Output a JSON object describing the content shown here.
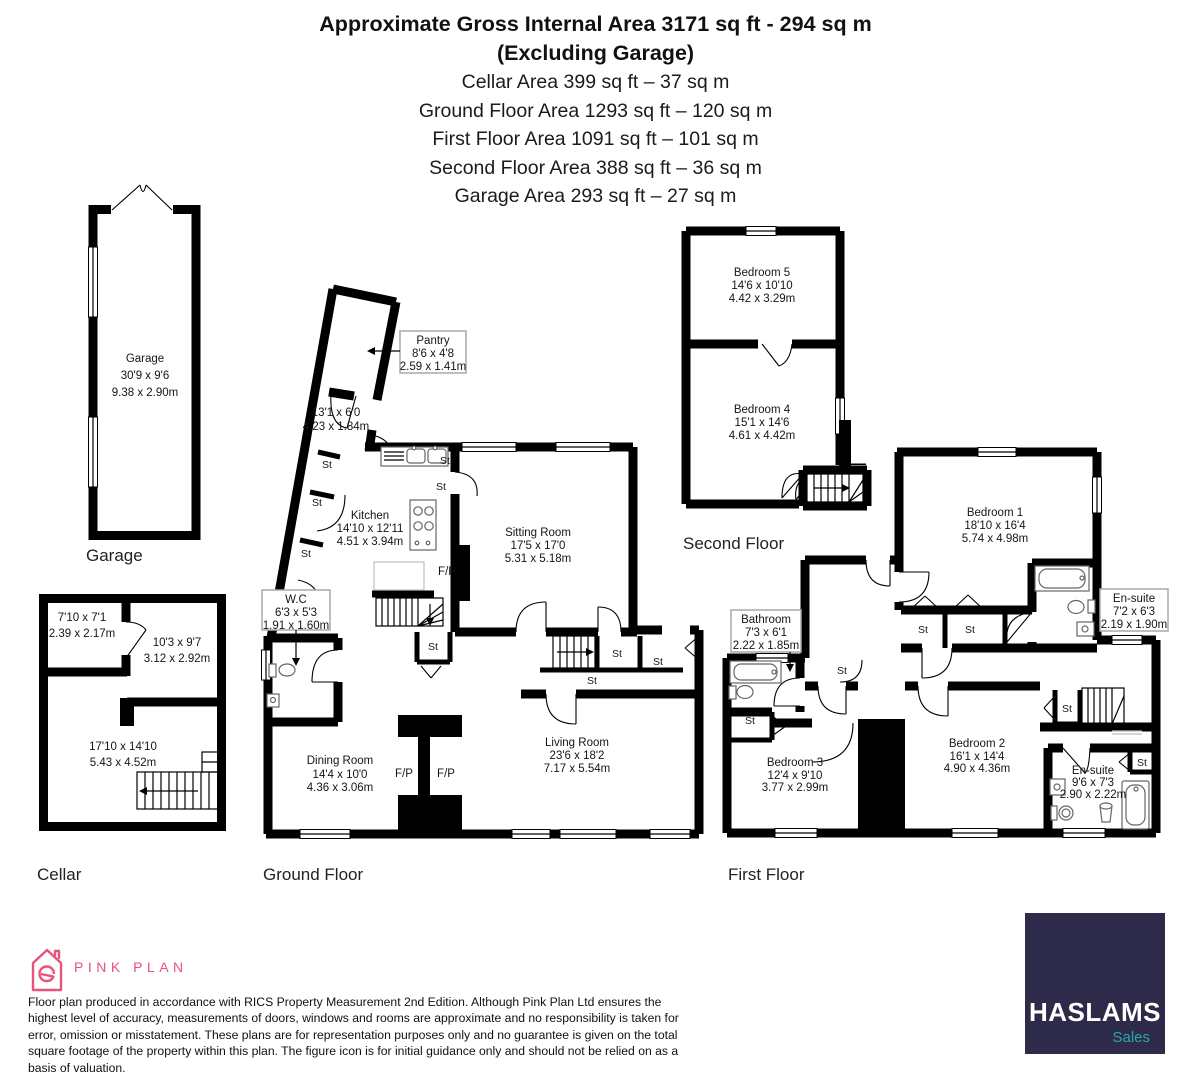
{
  "header": {
    "title1": "Approximate Gross Internal Area 3171 sq ft - 294 sq m",
    "title2": "(Excluding Garage)",
    "areas": [
      "Cellar Area 399 sq ft – 37 sq m",
      "Ground Floor Area 1293 sq ft – 120 sq m",
      "First Floor Area 1091 sq ft – 101 sq m",
      "Second Floor Area 388 sq ft – 36 sq m",
      "Garage Area 293 sq ft – 27 sq m"
    ]
  },
  "floors": {
    "garage": {
      "label": "Garage",
      "room": {
        "name": "Garage",
        "imperial": "30'9 x 9'6",
        "metric": "9.38 x 2.90m"
      }
    },
    "cellar": {
      "label": "Cellar",
      "rooms": {
        "r1": {
          "imperial": "7'10 x 7'1",
          "metric": "2.39 x 2.17m"
        },
        "r2": {
          "imperial": "10'3 x 9'7",
          "metric": "3.12 x 2.92m"
        },
        "r3": {
          "imperial": "17'10 x 14'10",
          "metric": "5.43 x 4.52m"
        }
      }
    },
    "ground": {
      "label": "Ground Floor",
      "rooms": {
        "pantry": {
          "name": "Pantry",
          "imperial": "8'6 x 4'8",
          "metric": "2.59 x 1.41m"
        },
        "corridor": {
          "imperial": "13'1 x 6'0",
          "metric": "4.23 x 1.84m"
        },
        "kitchen": {
          "name": "Kitchen",
          "imperial": "14'10 x 12'11",
          "metric": "4.51 x 3.94m"
        },
        "sitting": {
          "name": "Sitting Room",
          "imperial": "17'5 x 17'0",
          "metric": "5.31 x 5.18m"
        },
        "wc": {
          "name": "W.C",
          "imperial": "6'3 x 5'3",
          "metric": "1.91 x 1.60m"
        },
        "dining": {
          "name": "Dining Room",
          "imperial": "14'4 x 10'0",
          "metric": "4.36 x 3.06m"
        },
        "living": {
          "name": "Living Room",
          "imperial": "23'6 x 18'2",
          "metric": "7.17 x 5.54m"
        }
      }
    },
    "first": {
      "label": "First Floor",
      "rooms": {
        "bedroom1": {
          "name": "Bedroom 1",
          "imperial": "18'10 x 16'4",
          "metric": "5.74 x 4.98m"
        },
        "bedroom2": {
          "name": "Bedroom 2",
          "imperial": "16'1 x 14'4",
          "metric": "4.90 x 4.36m"
        },
        "bedroom3": {
          "name": "Bedroom 3",
          "imperial": "12'4 x 9'10",
          "metric": "3.77 x 2.99m"
        },
        "bathroom": {
          "name": "Bathroom",
          "imperial": "7'3 x 6'1",
          "metric": "2.22 x 1.85m"
        },
        "ensuite1": {
          "name": "En-suite",
          "imperial": "7'2 x 6'3",
          "metric": "2.19 x 1.90m"
        },
        "ensuite2": {
          "name": "En-suite",
          "imperial": "9'6 x 7'3",
          "metric": "2.90 x 2.22m"
        }
      }
    },
    "second": {
      "label": "Second Floor",
      "rooms": {
        "bedroom5": {
          "name": "Bedroom 5",
          "imperial": "14'6 x 10'10",
          "metric": "4.42 x 3.29m"
        },
        "bedroom4": {
          "name": "Bedroom 4",
          "imperial": "15'1 x 14'6",
          "metric": "4.61 x 4.42m"
        }
      }
    }
  },
  "labels": {
    "st": "St",
    "fp": "F/P"
  },
  "footer": {
    "brand": "PINK PLAN",
    "disclaimer": "Floor plan produced in accordance with RICS Property Measurement 2nd Edition. Although Pink Plan Ltd ensures the highest level of accuracy, measurements of doors, windows and rooms are approximate and no responsibility is taken for error, omission or misstatement. These plans are for representation purposes only and no guarantee is given on the total square footage of the property within this plan. The figure icon is for initial guidance only and should not be relied on as a basis of valuation.",
    "agency": {
      "name": "HASLAMS",
      "division": "Sales"
    }
  },
  "colors": {
    "pink": "#e8537a",
    "navy": "#2d2a4a",
    "teal": "#2aa9a9",
    "wall": "#000000"
  }
}
